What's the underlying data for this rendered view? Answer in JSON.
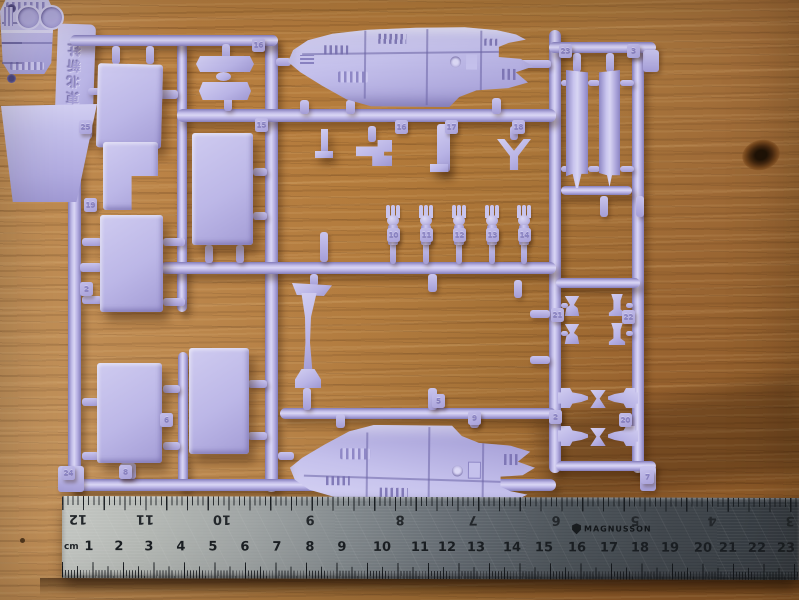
{
  "sprue": {
    "maker_tag_text": "©東北新社",
    "carrier_label_text": "母空段三",
    "part_number_tags": [
      {
        "label": "25",
        "x": 79,
        "y": 120
      },
      {
        "label": "19",
        "x": 84,
        "y": 198
      },
      {
        "label": "2",
        "x": 80,
        "y": 282
      },
      {
        "label": "16",
        "x": 252,
        "y": 38
      },
      {
        "label": "15",
        "x": 255,
        "y": 118
      },
      {
        "label": "16",
        "x": 395,
        "y": 120
      },
      {
        "label": "17",
        "x": 445,
        "y": 120
      },
      {
        "label": "18",
        "x": 512,
        "y": 120
      },
      {
        "label": "23",
        "x": 559,
        "y": 44
      },
      {
        "label": "3",
        "x": 627,
        "y": 44
      },
      {
        "label": "10",
        "x": 387,
        "y": 228
      },
      {
        "label": "11",
        "x": 420,
        "y": 228
      },
      {
        "label": "12",
        "x": 453,
        "y": 228
      },
      {
        "label": "13",
        "x": 486,
        "y": 228
      },
      {
        "label": "14",
        "x": 518,
        "y": 228
      },
      {
        "label": "5",
        "x": 432,
        "y": 394
      },
      {
        "label": "9",
        "x": 468,
        "y": 411
      },
      {
        "label": "21",
        "x": 551,
        "y": 308
      },
      {
        "label": "22",
        "x": 622,
        "y": 310
      },
      {
        "label": "2",
        "x": 549,
        "y": 410
      },
      {
        "label": "20",
        "x": 619,
        "y": 413
      },
      {
        "label": "24",
        "x": 62,
        "y": 466
      },
      {
        "label": "8",
        "x": 119,
        "y": 465
      },
      {
        "label": "7",
        "x": 641,
        "y": 470
      },
      {
        "label": "6",
        "x": 160,
        "y": 413
      }
    ],
    "turrets": [
      {
        "x": 384
      },
      {
        "x": 417
      },
      {
        "x": 450
      },
      {
        "x": 483
      },
      {
        "x": 515
      }
    ]
  },
  "ruler": {
    "brand": "MAGNUSSON",
    "unit_label": "cm",
    "cm_numbers": [
      {
        "label": "1",
        "x": 27
      },
      {
        "label": "2",
        "x": 57
      },
      {
        "label": "3",
        "x": 87
      },
      {
        "label": "4",
        "x": 119
      },
      {
        "label": "5",
        "x": 151
      },
      {
        "label": "6",
        "x": 183
      },
      {
        "label": "7",
        "x": 215
      },
      {
        "label": "8",
        "x": 248
      },
      {
        "label": "9",
        "x": 280
      },
      {
        "label": "10",
        "x": 320
      },
      {
        "label": "11",
        "x": 358
      },
      {
        "label": "12",
        "x": 385
      },
      {
        "label": "13",
        "x": 414
      },
      {
        "label": "14",
        "x": 450
      },
      {
        "label": "15",
        "x": 482
      },
      {
        "label": "16",
        "x": 515
      },
      {
        "label": "17",
        "x": 547
      },
      {
        "label": "18",
        "x": 578
      },
      {
        "label": "19",
        "x": 608
      },
      {
        "label": "20",
        "x": 641
      },
      {
        "label": "21",
        "x": 666
      },
      {
        "label": "22",
        "x": 695
      },
      {
        "label": "23",
        "x": 724
      },
      {
        "label": "24",
        "x": 756
      }
    ],
    "inch_numbers": [
      {
        "label": "12",
        "x": 16
      },
      {
        "label": "11",
        "x": 83
      },
      {
        "label": "10",
        "x": 160
      },
      {
        "label": "9",
        "x": 248
      },
      {
        "label": "8",
        "x": 338
      },
      {
        "label": "7",
        "x": 411
      },
      {
        "label": "6",
        "x": 494
      },
      {
        "label": "5",
        "x": 573
      },
      {
        "label": "4",
        "x": 650
      },
      {
        "label": "3",
        "x": 728
      }
    ]
  }
}
